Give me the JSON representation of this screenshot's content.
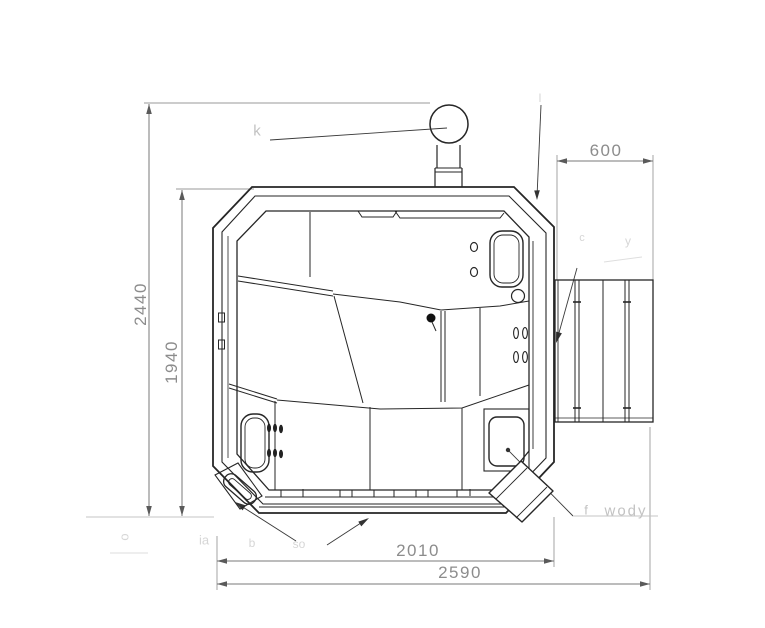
{
  "page": {
    "background": "#ffffff",
    "line_color": "#262626",
    "dim_line_color": "#7a7a7a",
    "dim_text_color": "#8c8c8c",
    "faint_text_color": "#c2c2c2"
  },
  "dimensions": {
    "total_height": "2440",
    "inner_height": "1940",
    "deck_width": "600",
    "body_width": "2010",
    "total_width": "2590"
  },
  "annotations": {
    "chimney_fragment": "k",
    "rim_corner_fragment": "l",
    "deck_fragment_a": "c",
    "deck_fragment_b": "y",
    "drain_fragment": "f",
    "drain_label": "wody",
    "bottom_fragment_a": "ia",
    "bottom_fragment_b": "b",
    "bottom_fragment_c": "so",
    "left_edge_fragment": "o"
  }
}
